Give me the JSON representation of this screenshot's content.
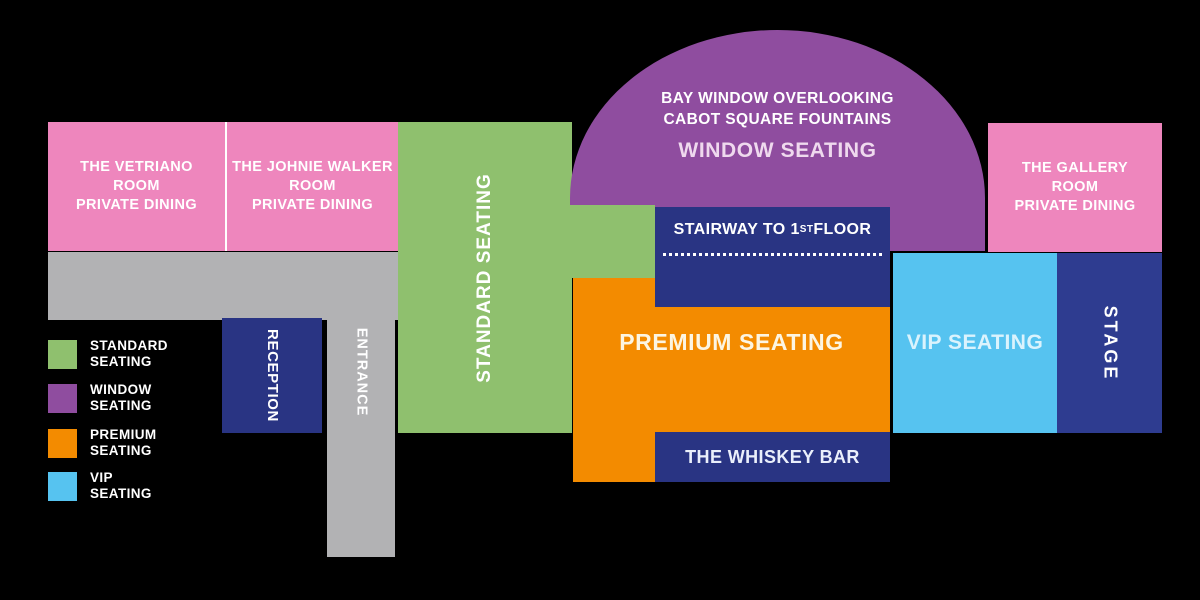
{
  "colors": {
    "background": "#000000",
    "standard_seating": "#8FC06E",
    "window_seating": "#8F4D9F",
    "premium_seating": "#F38B00",
    "vip_seating": "#56C3F0",
    "private_dining_pink": "#EE86BD",
    "navy": "#293483",
    "stage_navy": "#2E3C90",
    "corridor_gray": "#B2B2B4",
    "label_white": "#FFFFFF"
  },
  "rooms": {
    "vetriano": {
      "line1": "THE VETRIANO",
      "line2": "ROOM",
      "line3": "PRIVATE DINING"
    },
    "johnie_walker": {
      "line1": "THE JOHNIE WALKER",
      "line2": "ROOM",
      "line3": "PRIVATE DINING"
    },
    "gallery": {
      "line1": "THE GALLERY",
      "line2": "ROOM",
      "line3": "PRIVATE DINING"
    }
  },
  "areas": {
    "standard_seating": {
      "label": "STANDARD SEATING"
    },
    "window_seating": {
      "caption_line1": "BAY WINDOW OVERLOOKING",
      "caption_line2": "CABOT SQUARE FOUNTAINS",
      "label": "WINDOW SEATING"
    },
    "stairway": {
      "prefix": "STAIRWAY TO 1",
      "superscript": "ST",
      "suffix": " FLOOR"
    },
    "premium_seating": {
      "label": "PREMIUM SEATING"
    },
    "vip_seating": {
      "label": "VIP SEATING"
    },
    "whiskey_bar": {
      "label": "THE WHISKEY BAR"
    },
    "stage": {
      "label": "STAGE"
    },
    "reception": {
      "label": "RECEPTION"
    },
    "entrance": {
      "label": "ENTRANCE"
    }
  },
  "legend": {
    "items": [
      {
        "swatch": "#8FC06E",
        "line1": "STANDARD",
        "line2": "SEATING"
      },
      {
        "swatch": "#8F4D9F",
        "line1": "WINDOW",
        "line2": "SEATING"
      },
      {
        "swatch": "#F38B00",
        "line1": "PREMIUM",
        "line2": "SEATING"
      },
      {
        "swatch": "#56C3F0",
        "line1": "VIP",
        "line2": "SEATING"
      }
    ]
  }
}
